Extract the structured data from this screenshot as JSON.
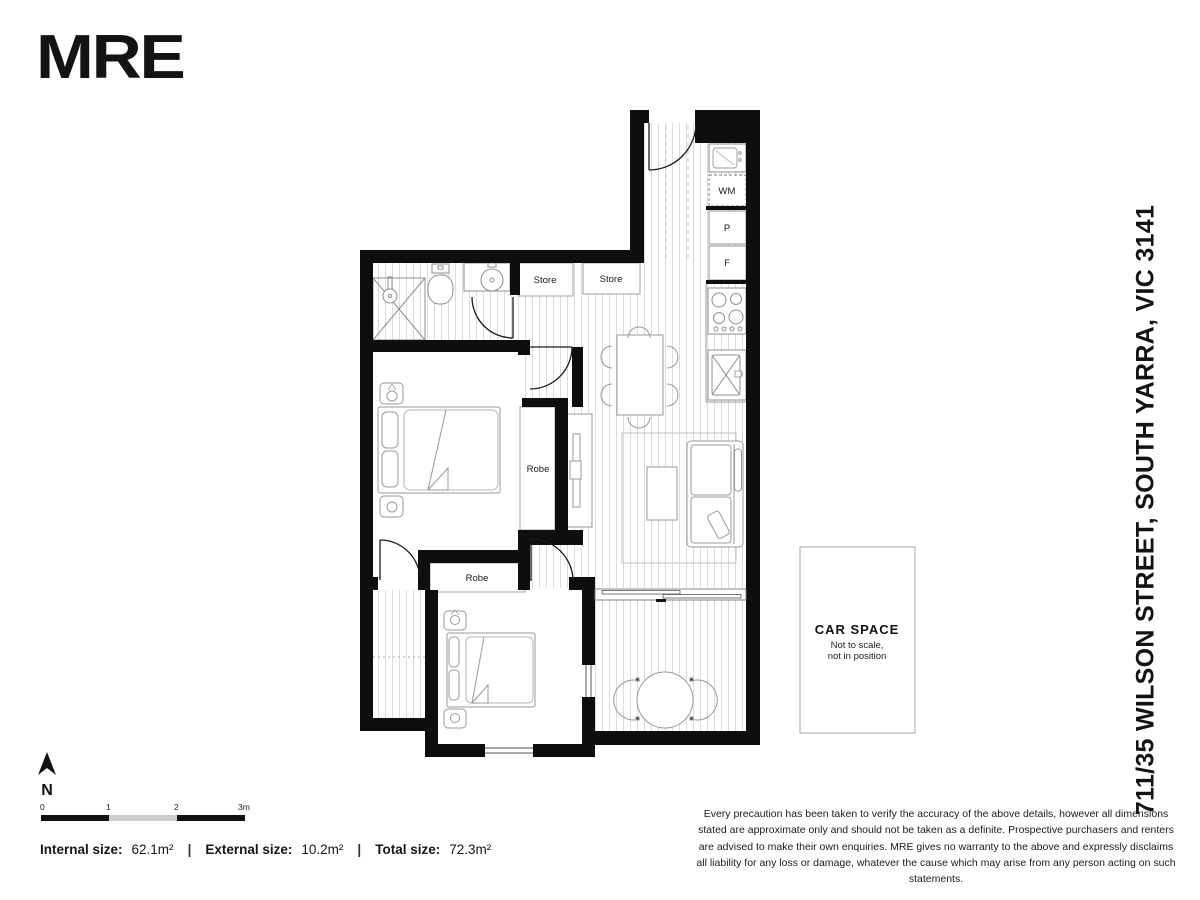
{
  "logo": "MRE",
  "address": "711/35 WILSON STREET, SOUTH YARRA, VIC 3141",
  "plan": {
    "labels": {
      "wm": "WM",
      "pantry": "P",
      "fridge": "F",
      "store1": "Store",
      "store2": "Store",
      "robe1": "Robe",
      "robe2": "Robe"
    },
    "car_space": {
      "title": "CAR SPACE",
      "note1": "Not to scale,",
      "note2": "not in position"
    }
  },
  "compass": {
    "label": "N"
  },
  "scale_bar": {
    "ticks": [
      "0",
      "1",
      "2",
      "3m"
    ]
  },
  "sizes": {
    "internal_label": "Internal size:",
    "internal_value": "62.1m²",
    "external_label": "External size:",
    "external_value": "10.2m²",
    "total_label": "Total size:",
    "total_value": "72.3m²",
    "separator": "|"
  },
  "disclaimer": "Every precaution has been taken to verify the accuracy of the above details, however all dimensions stated are approximate only and should not be taken as a definite. Prospective purchasers and renters are advised to make their own enquiries. MRE gives no warranty to the above and expressly disclaims all liability for any loss or damage, whatever the cause which may arise from any person acting on such statements.",
  "colors": {
    "wall": "#0e0e0e",
    "floor_line": "#dcdcdc",
    "fixture": "#999999",
    "scale_grey": "#c9ced1"
  }
}
